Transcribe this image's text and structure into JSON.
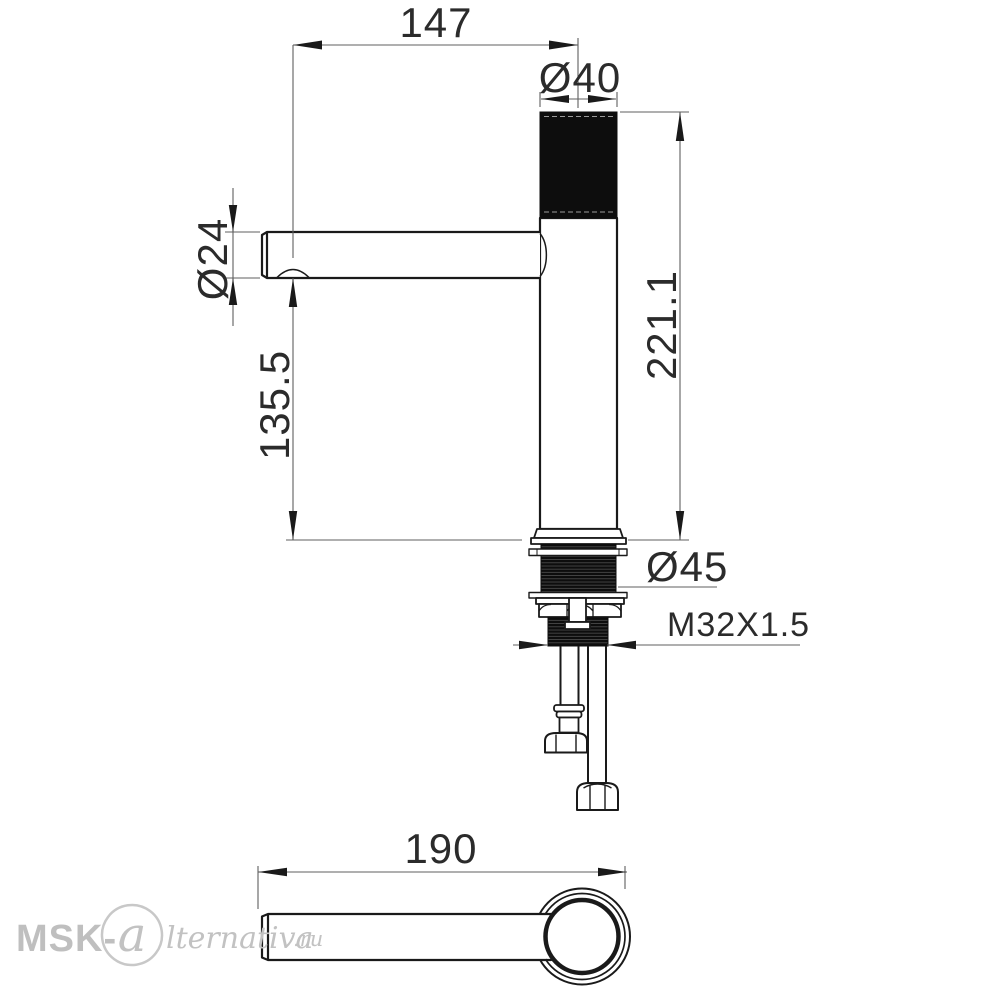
{
  "drawing": {
    "type": "technical-dimension-drawing",
    "subject": "single-lever basin faucet, side elevation and top view of spout",
    "dimensions": {
      "spout_reach": "147",
      "cap_diameter": "Ø40",
      "spout_diameter": "Ø24",
      "total_height": "221.1",
      "spout_height": "135.5",
      "base_flange_diameter": "Ø45",
      "mounting_thread": "M32X1.5",
      "spout_overall_length": "190"
    },
    "colors": {
      "outline": "#1a1a1a",
      "dimension_line": "#5f5f5f",
      "text": "#2b2b2b",
      "dark_fill": "#0d0d0d",
      "watermark": "#c2c2c2",
      "background": "#ffffff"
    }
  },
  "watermark": {
    "prefix": "MSK-",
    "monogram": "a",
    "name_rest": "lternativa",
    "tld": ".ru"
  }
}
